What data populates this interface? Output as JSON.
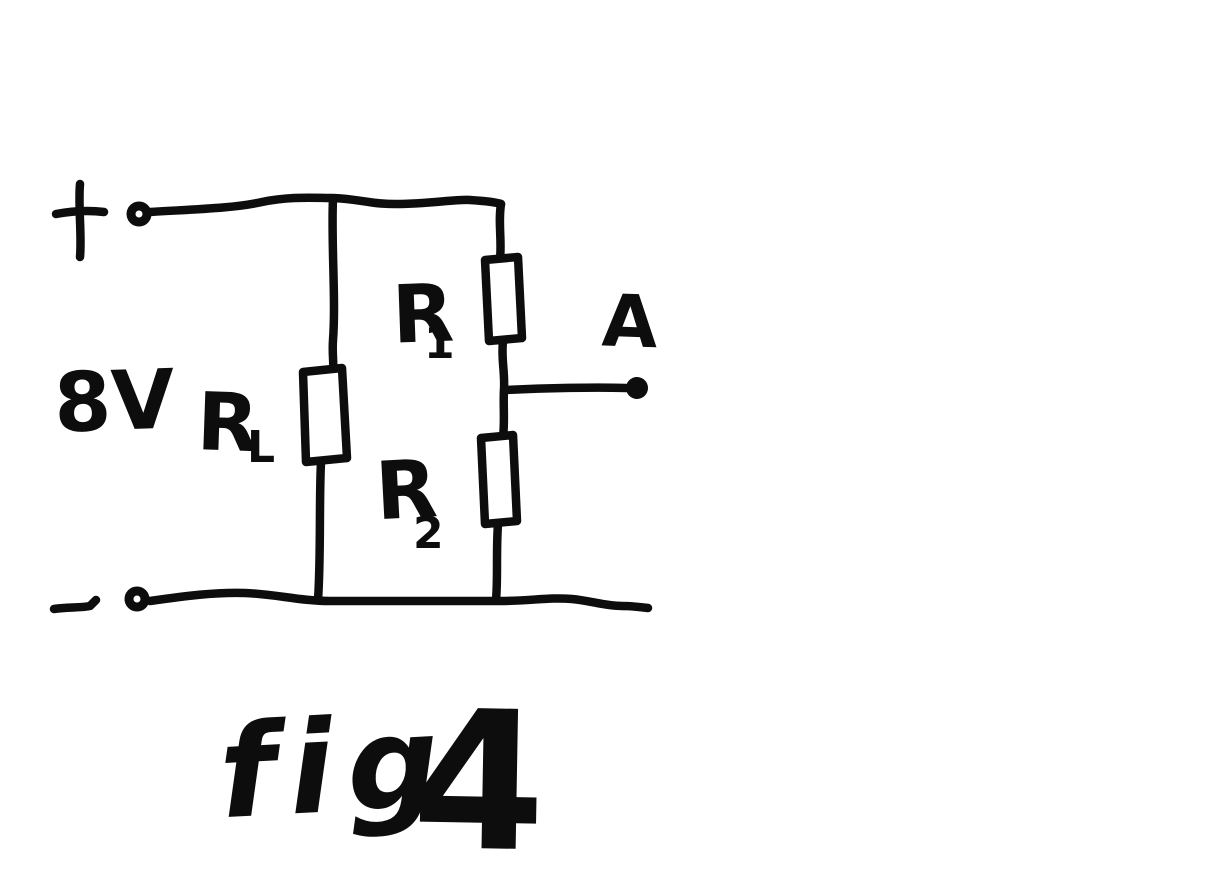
{
  "figure": {
    "caption_word": "fig",
    "caption_number": "4",
    "ink_color": "#0d0d0d",
    "background_color": "#ffffff"
  },
  "circuit": {
    "source": {
      "voltage_label": "8V",
      "positive_sign": "+",
      "negative_sign": "-"
    },
    "output_terminal_label": "A",
    "resistors": {
      "load": {
        "letter": "R",
        "subscript": "L"
      },
      "upper": {
        "letter": "R",
        "subscript": "1"
      },
      "lower": {
        "letter": "R",
        "subscript": "2"
      }
    }
  }
}
